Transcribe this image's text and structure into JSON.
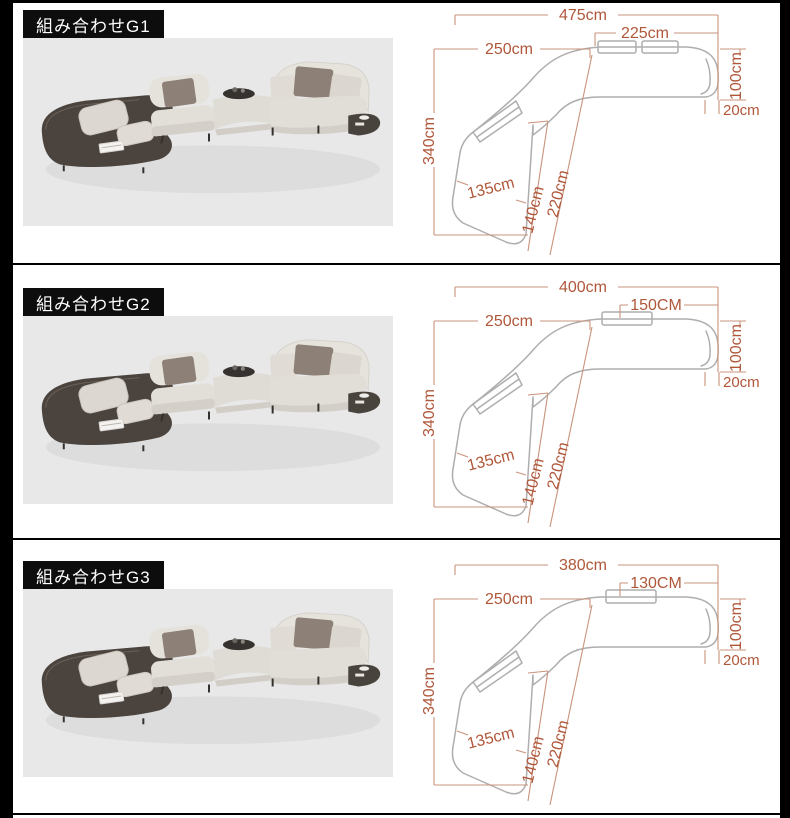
{
  "palette": {
    "frame_border": "#000000",
    "page_background": "#ffffff",
    "label_background": "#0d0d0d",
    "label_text": "#ffffff",
    "photo_background": "#e8e8e8",
    "dimension_text": "#b0573a",
    "dimension_line": "#c9937c",
    "drawing_outline": "#aeaeae",
    "platform_dark": "#4b433e",
    "sofa_fabric": "#e2dfd9",
    "cushion_dark": "#8d8076",
    "cushion_light": "#dcd7d0"
  },
  "sections": [
    {
      "id": "G1",
      "label": "組み合わせG1",
      "dimensions": {
        "total_width": "475cm",
        "front_width": "250cm",
        "right_section_width": "225cm",
        "right_depth": "100cm",
        "corner_gap": "20cm",
        "total_depth": "340cm",
        "chaise_width": "135cm",
        "chaise_depth": "140cm",
        "chaise_length": "220cm"
      }
    },
    {
      "id": "G2",
      "label": "組み合わせG2",
      "dimensions": {
        "total_width": "400cm",
        "front_width": "250cm",
        "right_section_width": "150CM",
        "right_depth": "100cm",
        "corner_gap": "20cm",
        "total_depth": "340cm",
        "chaise_width": "135cm",
        "chaise_depth": "140cm",
        "chaise_length": "220cm"
      }
    },
    {
      "id": "G3",
      "label": "組み合わせG3",
      "dimensions": {
        "total_width": "380cm",
        "front_width": "250cm",
        "right_section_width": "130CM",
        "right_depth": "100cm",
        "corner_gap": "20cm",
        "total_depth": "340cm",
        "chaise_width": "135cm",
        "chaise_depth": "140cm",
        "chaise_length": "220cm"
      }
    }
  ]
}
